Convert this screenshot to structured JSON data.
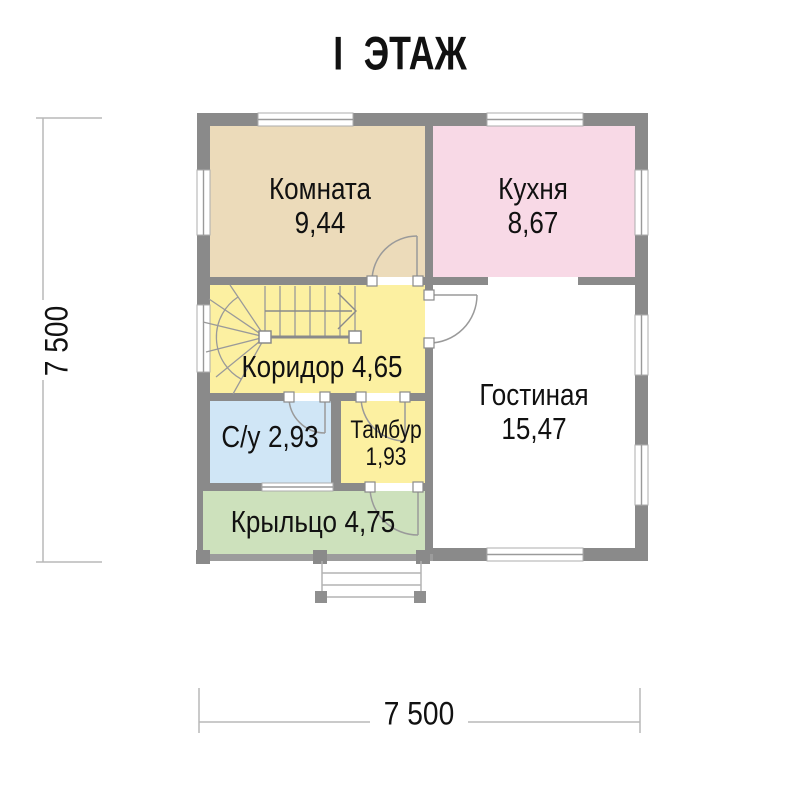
{
  "title": "I ЭТАЖ",
  "dimensions": {
    "width_label": "7 500",
    "height_label": "7 500"
  },
  "rooms": {
    "komnata": {
      "name": "Комната",
      "area": "9,44",
      "color": "#ecdbba"
    },
    "kuhnya": {
      "name": "Кухня",
      "area": "8,67",
      "color": "#f8d9e6"
    },
    "koridor": {
      "name": "Коридор",
      "area": "4,65",
      "color": "#fcf0a1"
    },
    "gostinaya": {
      "name": "Гостиная",
      "area": "15,47",
      "color": "#ffffff"
    },
    "su": {
      "name": "С/у",
      "area": "2,93",
      "color": "#d0e6f6"
    },
    "tambur": {
      "name": "Тамбур",
      "area": "1,93",
      "color": "#fcf0a1"
    },
    "krylco": {
      "name": "Крыльцо",
      "area": "4,75",
      "color": "#cde1bc"
    }
  },
  "palette": {
    "wall": "#8a8a8a",
    "thin_line": "#9a9a9a",
    "step_line": "#b3b3b3",
    "dim_line": "#b8b8b8",
    "text": "#111111"
  }
}
